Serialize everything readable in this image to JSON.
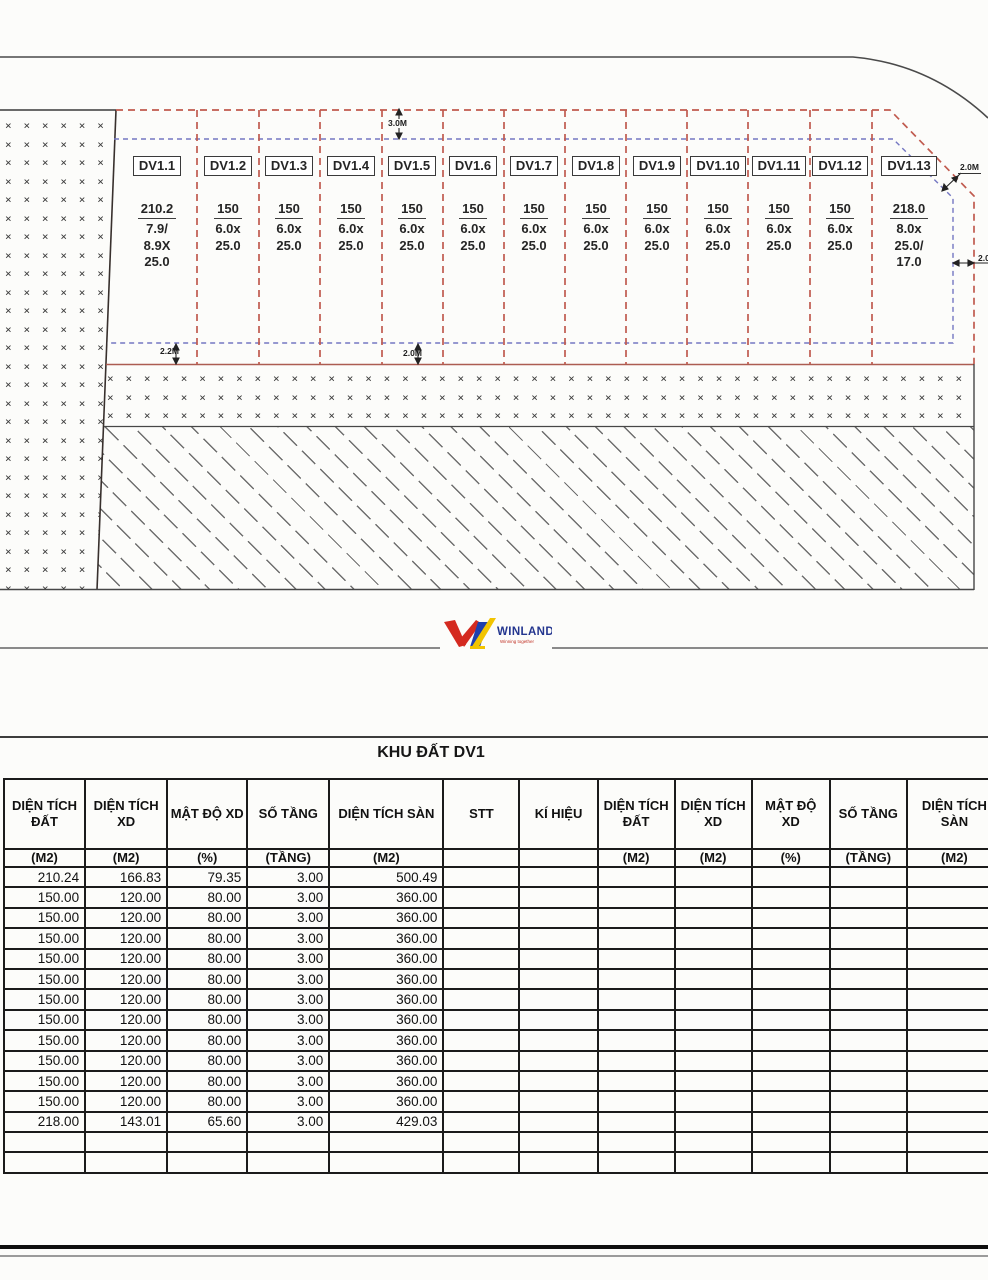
{
  "plan": {
    "dimensions": {
      "top": "3.0M",
      "bottom_left": "2.2M",
      "bottom_mid": "2.0M",
      "right_upper": "2.0M",
      "right_lower": "2.0M"
    },
    "plots": [
      {
        "id": "DV1.1",
        "area": "210.2",
        "size_lines": [
          "7.9/",
          "8.9X",
          "25.0"
        ]
      },
      {
        "id": "DV1.2",
        "area": "150",
        "size_lines": [
          "6.0x",
          "25.0"
        ]
      },
      {
        "id": "DV1.3",
        "area": "150",
        "size_lines": [
          "6.0x",
          "25.0"
        ]
      },
      {
        "id": "DV1.4",
        "area": "150",
        "size_lines": [
          "6.0x",
          "25.0"
        ]
      },
      {
        "id": "DV1.5",
        "area": "150",
        "size_lines": [
          "6.0x",
          "25.0"
        ]
      },
      {
        "id": "DV1.6",
        "area": "150",
        "size_lines": [
          "6.0x",
          "25.0"
        ]
      },
      {
        "id": "DV1.7",
        "area": "150",
        "size_lines": [
          "6.0x",
          "25.0"
        ]
      },
      {
        "id": "DV1.8",
        "area": "150",
        "size_lines": [
          "6.0x",
          "25.0"
        ]
      },
      {
        "id": "DV1.9",
        "area": "150",
        "size_lines": [
          "6.0x",
          "25.0"
        ]
      },
      {
        "id": "DV1.10",
        "area": "150",
        "size_lines": [
          "6.0x",
          "25.0"
        ]
      },
      {
        "id": "DV1.11",
        "area": "150",
        "size_lines": [
          "6.0x",
          "25.0"
        ]
      },
      {
        "id": "DV1.12",
        "area": "150",
        "size_lines": [
          "6.0x",
          "25.0"
        ]
      },
      {
        "id": "DV1.13",
        "area": "218.0",
        "size_lines": [
          "8.0x",
          "25.0/",
          "17.0"
        ]
      }
    ]
  },
  "logo": {
    "name": "WINLAND",
    "tagline": "Winning together"
  },
  "table": {
    "title": "KHU ĐẤT DV1",
    "columns": [
      {
        "label": "DIỆN TÍCH ĐẤT",
        "unit": "(M2)"
      },
      {
        "label": "DIỆN TÍCH XD",
        "unit": "(M2)"
      },
      {
        "label": "MẬT ĐỘ XD",
        "unit": "(%)"
      },
      {
        "label": "SỐ TẦNG",
        "unit": "(TẦNG)"
      },
      {
        "label": "DIỆN TÍCH SÀN",
        "unit": "(M2)"
      },
      {
        "label": "STT",
        "unit": ""
      },
      {
        "label": "KÍ HIỆU",
        "unit": ""
      },
      {
        "label": "DIỆN TÍCH ĐẤT",
        "unit": "(M2)"
      },
      {
        "label": "DIỆN TÍCH XD",
        "unit": "(M2)"
      },
      {
        "label": "MẬT ĐỘ XD",
        "unit": "(%)"
      },
      {
        "label": "SỐ TẦNG",
        "unit": "(TẦNG)"
      },
      {
        "label": "DIỆN TÍCH SÀN",
        "unit": "(M2)"
      }
    ],
    "rows": [
      [
        "210.24",
        "166.83",
        "79.35",
        "3.00",
        "500.49",
        "",
        "",
        "",
        "",
        "",
        "",
        ""
      ],
      [
        "150.00",
        "120.00",
        "80.00",
        "3.00",
        "360.00",
        "",
        "",
        "",
        "",
        "",
        "",
        ""
      ],
      [
        "150.00",
        "120.00",
        "80.00",
        "3.00",
        "360.00",
        "",
        "",
        "",
        "",
        "",
        "",
        ""
      ],
      [
        "150.00",
        "120.00",
        "80.00",
        "3.00",
        "360.00",
        "",
        "",
        "",
        "",
        "",
        "",
        ""
      ],
      [
        "150.00",
        "120.00",
        "80.00",
        "3.00",
        "360.00",
        "",
        "",
        "",
        "",
        "",
        "",
        ""
      ],
      [
        "150.00",
        "120.00",
        "80.00",
        "3.00",
        "360.00",
        "",
        "",
        "",
        "",
        "",
        "",
        ""
      ],
      [
        "150.00",
        "120.00",
        "80.00",
        "3.00",
        "360.00",
        "",
        "",
        "",
        "",
        "",
        "",
        ""
      ],
      [
        "150.00",
        "120.00",
        "80.00",
        "3.00",
        "360.00",
        "",
        "",
        "",
        "",
        "",
        "",
        ""
      ],
      [
        "150.00",
        "120.00",
        "80.00",
        "3.00",
        "360.00",
        "",
        "",
        "",
        "",
        "",
        "",
        ""
      ],
      [
        "150.00",
        "120.00",
        "80.00",
        "3.00",
        "360.00",
        "",
        "",
        "",
        "",
        "",
        "",
        ""
      ],
      [
        "150.00",
        "120.00",
        "80.00",
        "3.00",
        "360.00",
        "",
        "",
        "",
        "",
        "",
        "",
        ""
      ],
      [
        "150.00",
        "120.00",
        "80.00",
        "3.00",
        "360.00",
        "",
        "",
        "",
        "",
        "",
        "",
        ""
      ],
      [
        "218.00",
        "143.01",
        "65.60",
        "3.00",
        "429.03",
        "",
        "",
        "",
        "",
        "",
        "",
        ""
      ],
      [
        "",
        "",
        "",
        "",
        "",
        "",
        "",
        "",
        "",
        "",
        "",
        ""
      ],
      [
        "",
        "",
        "",
        "",
        "",
        "",
        "",
        "",
        "",
        "",
        "",
        ""
      ]
    ]
  },
  "colors": {
    "boundary_red": "#c05a4e",
    "boundary_blue": "#7477c2",
    "road_line": "#4a4a4a",
    "table_border": "#1b1b1b",
    "logo_red": "#d42a20",
    "logo_blue": "#1e3fae",
    "logo_yellow": "#f2c400",
    "logo_text": "#24368f"
  }
}
